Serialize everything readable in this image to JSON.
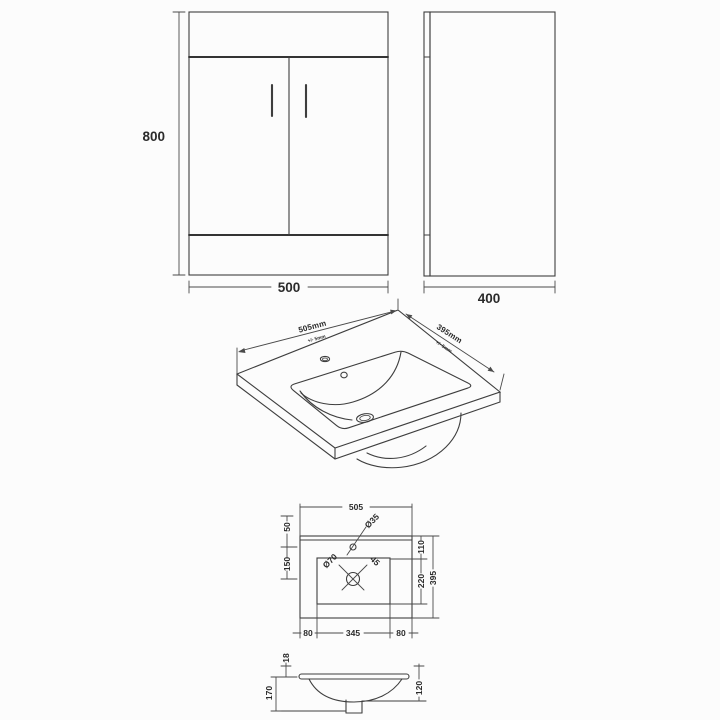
{
  "meta": {
    "description": "Technical dimension drawing: bathroom vanity unit with ceramic basin",
    "views": [
      "front elevation",
      "side elevation",
      "basin perspective",
      "basin plan",
      "basin section"
    ]
  },
  "colors": {
    "background": "#fcfcfc",
    "line": "#3e3e3e",
    "dimension_line": "#4a4a4a",
    "text": "#2b2b2b"
  },
  "cabinet_front": {
    "height": "800",
    "width": "500"
  },
  "cabinet_side": {
    "depth": "400"
  },
  "basin_3d": {
    "width": "505mm",
    "width_tolerance": "+/- 5mm",
    "depth": "395mm",
    "depth_tolerance": "+/- 5mm"
  },
  "basin_plan": {
    "overall_width": "505",
    "tap_setback": "50",
    "tap_to_waste": "150",
    "rim_to_bowl": "110",
    "bowl_depth": "220",
    "overall_depth": "395",
    "left_offset": "80",
    "bowl_width": "345",
    "right_offset": "80",
    "tap_hole_diameter": "Ø35",
    "waste_diameter": "Ø70",
    "waste_angle": "45"
  },
  "basin_section": {
    "rim_thickness": "18",
    "overall_height": "170",
    "bowl_height": "120"
  }
}
